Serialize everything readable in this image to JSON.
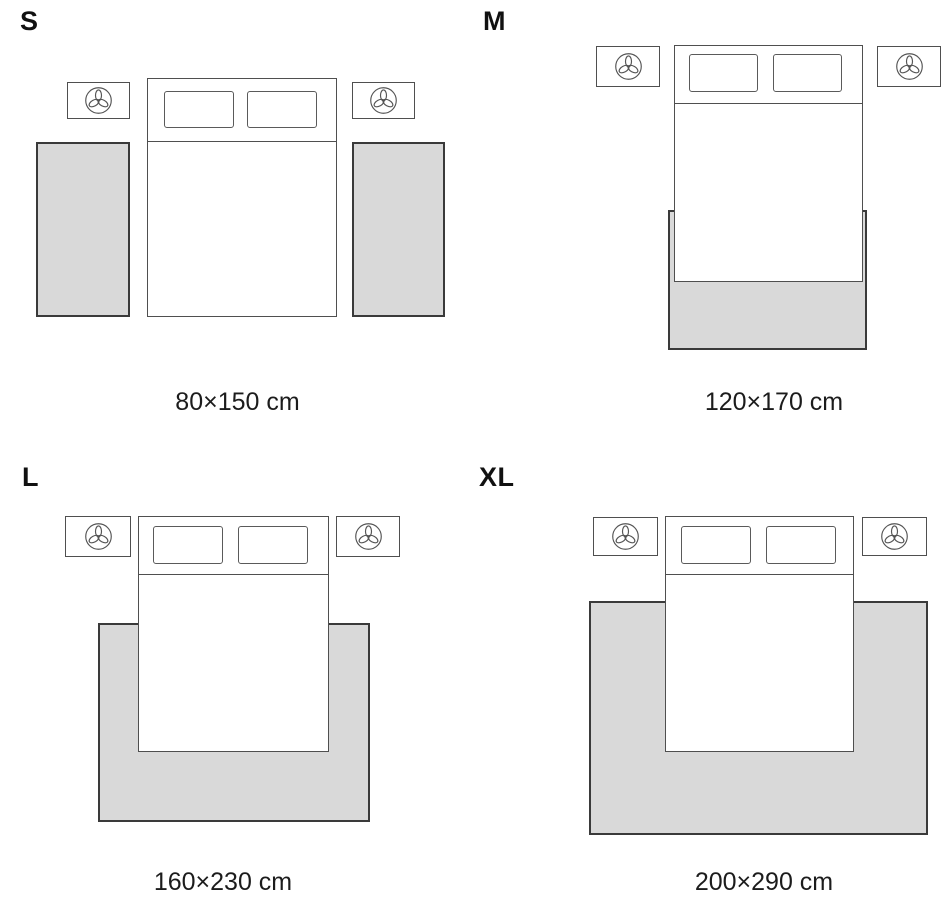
{
  "colors": {
    "background": "#ffffff",
    "rug_fill": "#d9d9d9",
    "rug_border": "#3a3a3a",
    "furniture_border": "#4f4f4f",
    "text": "#1c1c1c",
    "letter_text": "#111111"
  },
  "icons": {
    "nightstand_decor": "plant-icon"
  },
  "variants": [
    {
      "label": "S",
      "size": "80×150 cm"
    },
    {
      "label": "M",
      "size": "120×170 cm"
    },
    {
      "label": "L",
      "size": "160×230 cm"
    },
    {
      "label": "XL",
      "size": "200×290 cm"
    }
  ]
}
